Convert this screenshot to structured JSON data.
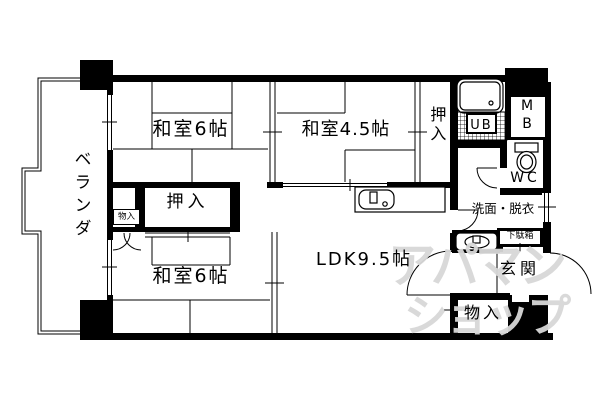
{
  "floorplan": {
    "rooms": {
      "veranda": {
        "label": "ベランダ"
      },
      "washitsu6_top": {
        "label": "和室6帖"
      },
      "washitsu45": {
        "label": "和室4.5帖"
      },
      "oshiire_top": {
        "label": "押入"
      },
      "unit_bath": {
        "label": "UB"
      },
      "meter_box": {
        "label": "MB"
      },
      "toilet": {
        "label": "WC"
      },
      "washroom": {
        "label": "洗面・脱衣"
      },
      "oshiire_middle": {
        "label": "押入"
      },
      "storage_small": {
        "label": "物入"
      },
      "washitsu6_bottom": {
        "label": "和室6帖"
      },
      "ldk": {
        "label": "LDK9.5帖"
      },
      "shoe_cabinet": {
        "label": "下駄箱"
      },
      "entrance": {
        "label": "玄関"
      },
      "storage_bottom": {
        "label": "物入"
      }
    },
    "watermark": {
      "line1": "アパマン",
      "line2": "ショップ"
    },
    "colors": {
      "wall": "#000000",
      "background": "#ffffff",
      "watermark": "#d8d8d8"
    }
  }
}
